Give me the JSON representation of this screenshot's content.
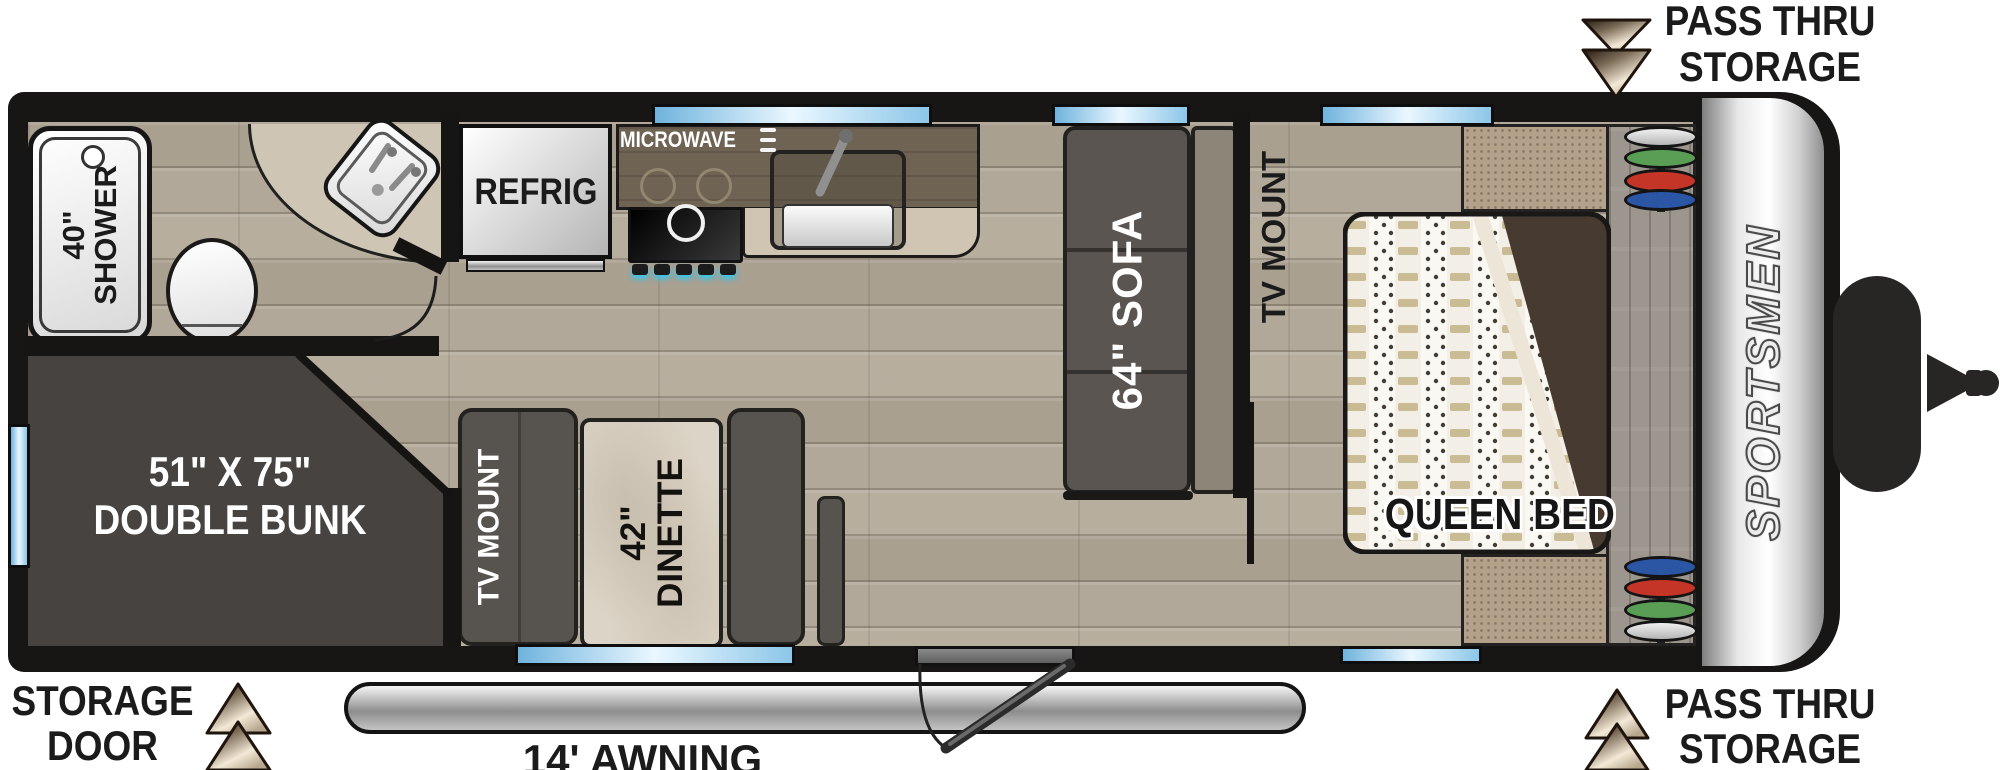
{
  "title": "Sportsmen travel trailer floor plan",
  "brand": {
    "logo_text": "SPORTSMEN"
  },
  "callouts": {
    "pass_thru_top": {
      "line1": "PASS THRU",
      "line2": "STORAGE",
      "icon": "double-down-arrow"
    },
    "pass_thru_bottom": {
      "line1": "PASS THRU",
      "line2": "STORAGE",
      "icon": "double-up-arrow"
    },
    "storage_door": {
      "line1": "STORAGE",
      "line2": "DOOR",
      "icon": "double-up-arrow"
    },
    "awning": {
      "label": "14' AWNING"
    }
  },
  "rooms": {
    "bathroom": {
      "shower": {
        "line1": "40\"",
        "line2": "SHOWER"
      }
    },
    "kitchen": {
      "refrigerator": "REFRIG",
      "microwave": "MICROWAVE"
    },
    "living": {
      "sofa": "64\" SOFA",
      "dinette": {
        "line1": "42\"",
        "line2": "DINETTE"
      },
      "tv_mount": "TV MOUNT"
    },
    "bedroom": {
      "bed": "QUEEN BED",
      "tv_mount": "TV MOUNT"
    },
    "bunk": {
      "line1": "51\" X 75\"",
      "line2": "DOUBLE BUNK"
    }
  },
  "colors": {
    "wall": "#171514",
    "window_blue": "#8cc6e8",
    "wood_floor": "#b7ae9f",
    "furniture_gray": "#57534f",
    "blanket_brown": "#473a31",
    "arrow_dark": "#241a12",
    "arrow_light": "#f3e9d6",
    "disc_green": "#5a9e55",
    "disc_red": "#c43527",
    "disc_blue": "#2a56a4",
    "disc_silver": "#d8d8d8"
  }
}
